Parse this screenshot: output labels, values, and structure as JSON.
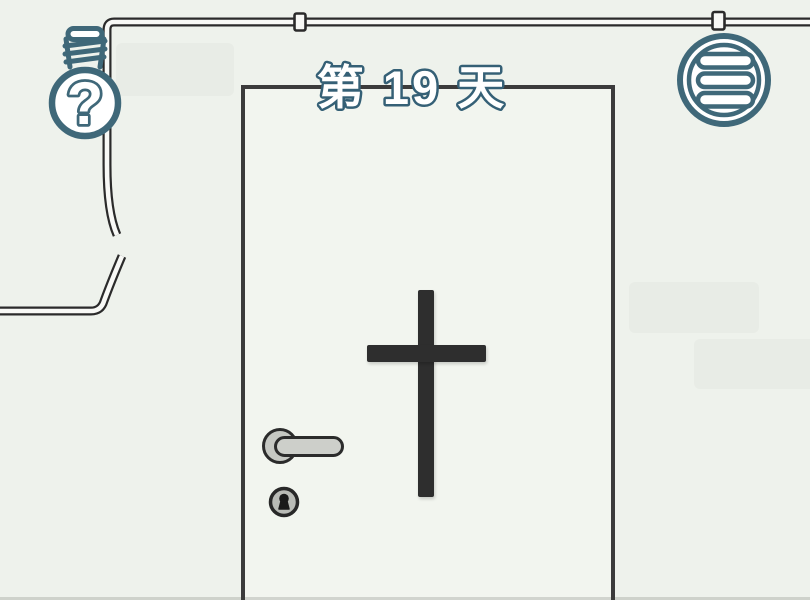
{
  "scene": {
    "title": "第 19 天",
    "hint_glyph": "?",
    "icons": {
      "hint": "lightbulb-question-icon",
      "menu": "hamburger-menu-icon"
    },
    "objects": [
      "broken-pipe",
      "door",
      "cross",
      "door-handle",
      "keyhole"
    ],
    "colors": {
      "background": "#eef2ec",
      "accent": "#3f6879",
      "outline_dark": "#2b2b2b",
      "cross": "#2e2e2e",
      "metal_gray": "#cdcfca",
      "metal_gray_dark": "#b9bbb6",
      "pipe_fill": "#f8f9f6",
      "wall_patch": "#e7eae4",
      "door_fill": "#f2f5ef",
      "door_line": "#3b3b3b",
      "title_fill": "#ffffff",
      "title_stroke": "#356076",
      "keyhole_dark": "#1a1a1a"
    }
  }
}
